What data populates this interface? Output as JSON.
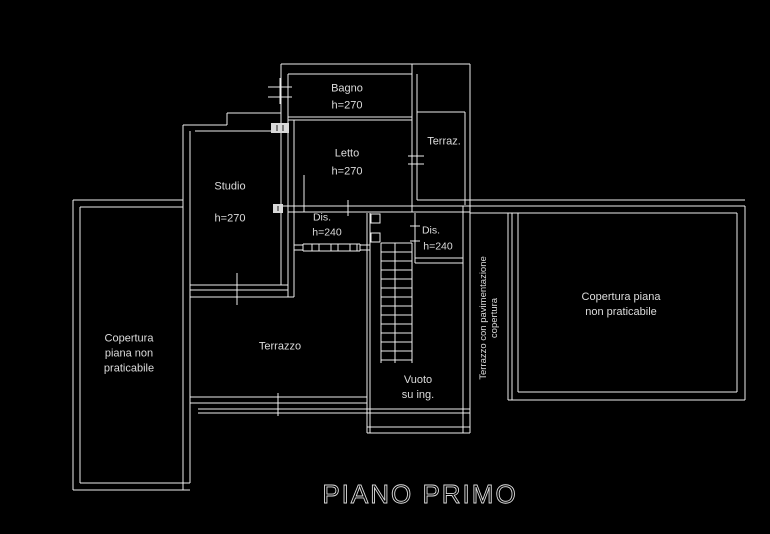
{
  "plan": {
    "title": "PIANO PRIMO"
  },
  "rooms": {
    "bagno": {
      "name": "Bagno",
      "height": "h=270"
    },
    "letto": {
      "name": "Letto",
      "height": "h=270"
    },
    "studio": {
      "name": "Studio",
      "height": "h=270"
    },
    "terrazzino": {
      "name": "Terraz."
    },
    "dis_left": {
      "name": "Dis.",
      "height": "h=240"
    },
    "dis_right": {
      "name": "Dis.",
      "height": "h=240"
    },
    "terrazzo": {
      "name": "Terrazzo"
    },
    "vuoto": {
      "line1": "Vuoto",
      "line2": "su ing."
    },
    "copertura_left": {
      "line1": "Copertura",
      "line2": "piana non",
      "line3": "praticabile"
    },
    "copertura_right": {
      "line1": "Copertura piana",
      "line2": "non praticabile"
    },
    "terrazzo_copertura": {
      "line1": "Terrazzo con pavimentazione",
      "line2": "copertura"
    }
  },
  "colors": {
    "background": "#000000",
    "line": "#ededed",
    "text": "#dcdcdc"
  }
}
